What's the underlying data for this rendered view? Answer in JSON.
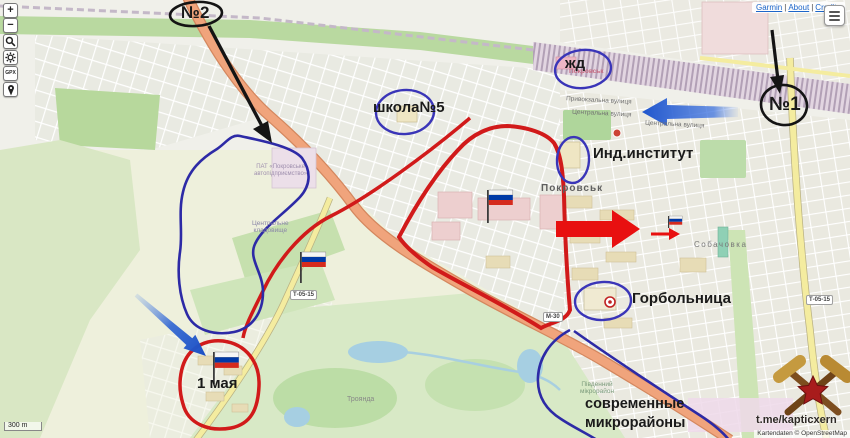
{
  "map_controls": {
    "zoom_in": "+",
    "zoom_out": "−",
    "gpx_label": "GPX"
  },
  "top_links": {
    "items": [
      "Garmin",
      "About",
      "Credits"
    ],
    "separator": "|"
  },
  "menu_icon": "hamburger",
  "scale_label": "300 m",
  "watermark": {
    "channel": "t.me/kapticxern",
    "attribution": "Kartendaten © OpenStreetMap"
  },
  "annotations": {
    "no2": "№2",
    "no1": "№1",
    "zhd": "жд",
    "school": "школа№5",
    "institute": "Инд.институт",
    "hospital": "Горбольница",
    "may1": "1 мая",
    "modern_line1": "современные",
    "modern_line2": "микрорайоны"
  },
  "map_labels": {
    "city": "Покровськ",
    "station": "Покровськ",
    "sobachovka": "Собачовка",
    "troyanda": "Троянда",
    "cemetery_line1": "Центральне",
    "cemetery_line2": "кладовище",
    "pat_line1": "ПАТ «Покровське",
    "pat_line2": "автопідприємство»",
    "district_line1": "Південний",
    "district_line2": "мікрорайон",
    "street_privokzalna": "Привокзальна вулиця",
    "street_centralna1": "Центральна вулиця",
    "street_centralna2": "Центральна вулиця",
    "shield_t1": "Т-05-15",
    "shield_t2": "Т-05-15",
    "shield_m": "М-30"
  },
  "colors": {
    "annotation_red": "#d11a1a",
    "arrow_red": "#e81010",
    "annotation_blue": "#3a35b8",
    "area_blue": "#2d2aa6",
    "arrow_blue": "#1e52c8",
    "annotation_black": "#141414",
    "flag_white": "#f5f5f5",
    "flag_blue": "#0039a6",
    "flag_red": "#d52b1e"
  }
}
